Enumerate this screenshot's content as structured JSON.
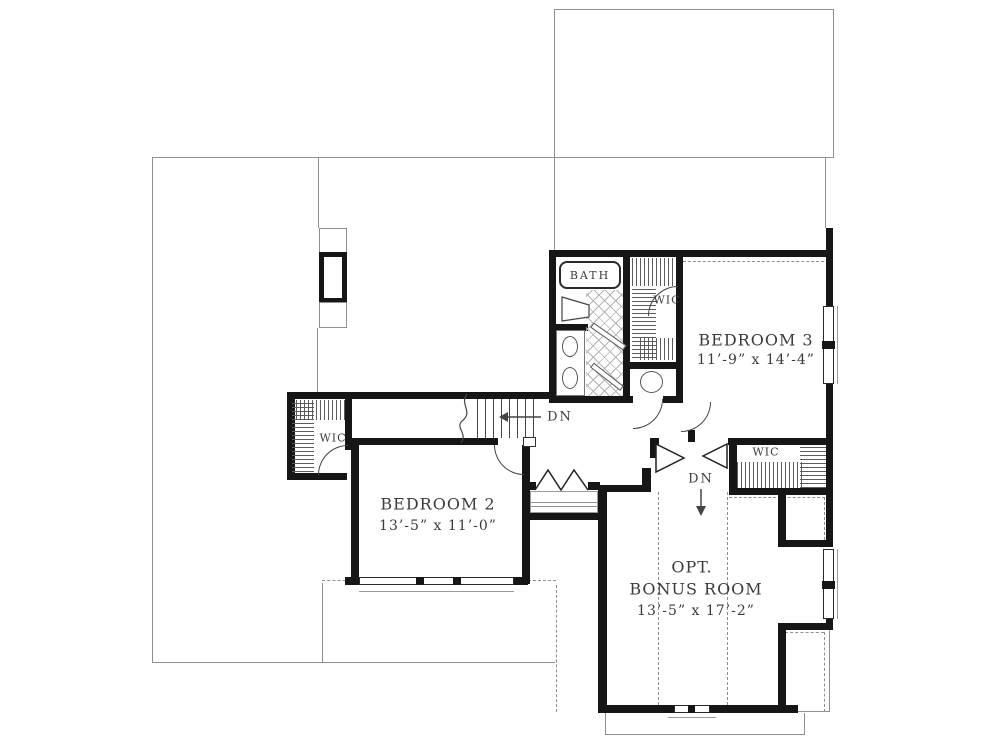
{
  "plan": {
    "rooms": {
      "bath": {
        "label": "BATH"
      },
      "wic_bedroom2": {
        "label": "WIC"
      },
      "wic_bedroom3": {
        "label": "WIC"
      },
      "wic_bonus": {
        "label": "WIC"
      },
      "bedroom3": {
        "name": "BEDROOM 3",
        "dims": "11’-9” x 14’-4”"
      },
      "bedroom2": {
        "name": "BEDROOM 2",
        "dims": "13’-5” x 11’-0”"
      },
      "bonus": {
        "line1": "OPT.",
        "line2": "BONUS ROOM",
        "dims": "13’-5” x 17’-2”"
      }
    },
    "stairs": {
      "down_label": "DN"
    },
    "bonus_stairs": {
      "down_label": "DN"
    },
    "colors": {
      "wall": "#161616",
      "thin_line": "#8f8f8f",
      "text": "#3b3b3b"
    }
  }
}
